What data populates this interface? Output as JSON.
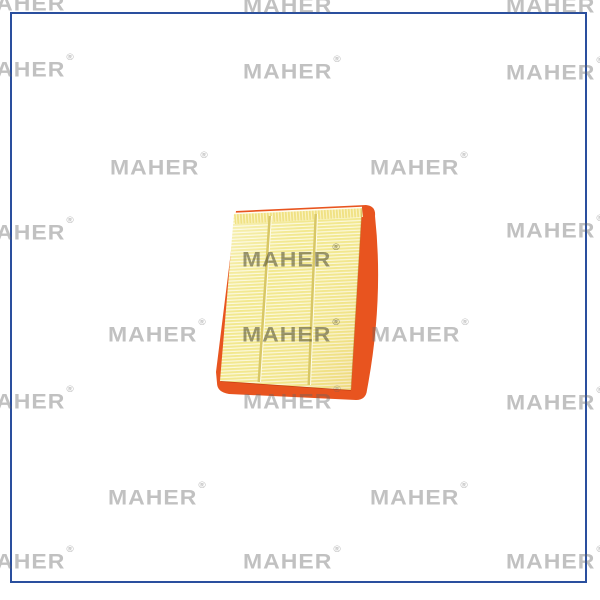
{
  "frame": {
    "border_color": "#2a4f9e"
  },
  "watermark": {
    "text": "MAHER",
    "registered_mark": "®",
    "color_light": "rgba(100,100,100,0.40)",
    "color_dark": "rgba(75,72,50,0.55)",
    "positions": [
      {
        "x": -24,
        "y": -7,
        "tone": "light"
      },
      {
        "x": 243,
        "y": -5,
        "tone": "light"
      },
      {
        "x": 506,
        "y": -5,
        "tone": "light"
      },
      {
        "x": -24,
        "y": 59,
        "tone": "light"
      },
      {
        "x": 243,
        "y": 61,
        "tone": "light"
      },
      {
        "x": 506,
        "y": 62,
        "tone": "light"
      },
      {
        "x": 110,
        "y": 157,
        "tone": "light"
      },
      {
        "x": 370,
        "y": 157,
        "tone": "light"
      },
      {
        "x": -24,
        "y": 222,
        "tone": "light"
      },
      {
        "x": 506,
        "y": 220,
        "tone": "light"
      },
      {
        "x": 242,
        "y": 249,
        "tone": "dark"
      },
      {
        "x": 108,
        "y": 324,
        "tone": "light"
      },
      {
        "x": 242,
        "y": 324,
        "tone": "dark"
      },
      {
        "x": 371,
        "y": 324,
        "tone": "light"
      },
      {
        "x": -24,
        "y": 391,
        "tone": "light"
      },
      {
        "x": 243,
        "y": 391,
        "tone": "light"
      },
      {
        "x": 506,
        "y": 392,
        "tone": "light"
      },
      {
        "x": 108,
        "y": 487,
        "tone": "light"
      },
      {
        "x": 370,
        "y": 487,
        "tone": "light"
      },
      {
        "x": -24,
        "y": 551,
        "tone": "light"
      },
      {
        "x": 243,
        "y": 551,
        "tone": "light"
      },
      {
        "x": 506,
        "y": 551,
        "tone": "light"
      }
    ]
  },
  "product": {
    "name": "air-filter",
    "colors": {
      "pleat_base": "#f2e88e",
      "pleat_light_line": "#fcf9dc",
      "pleat_top_base": "#f0e183",
      "pleat_top_line": "#faf3c2",
      "divider": "#d8c766",
      "divider_highlight": "#fffde8",
      "seal_orange": "#e8541f",
      "seal_shadow": "#c43f12",
      "edge_crease": "rgba(170,120,30,0.35)",
      "top_highlight": "#fffdf0"
    }
  }
}
